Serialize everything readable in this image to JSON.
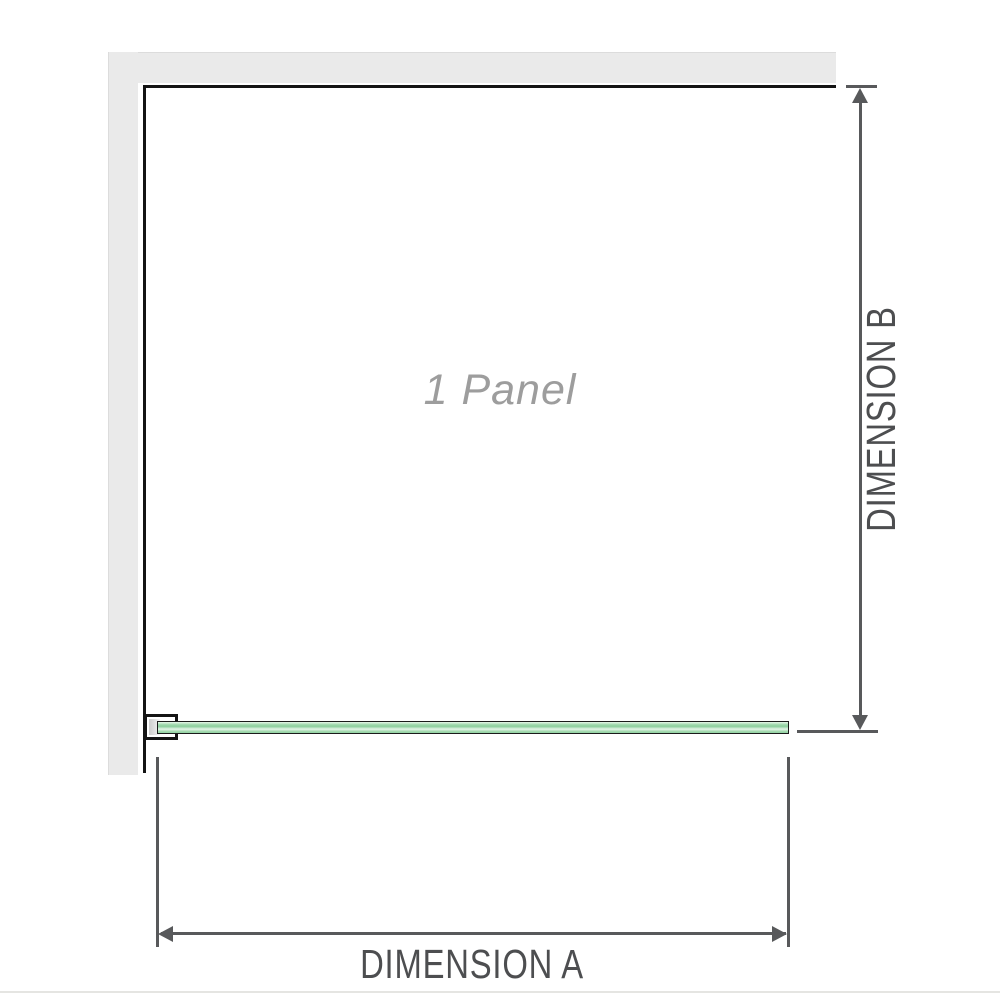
{
  "diagram": {
    "panel_label": "1 Panel",
    "dimension_a_label": "DIMENSION A",
    "dimension_b_label": "DIMENSION B"
  },
  "colors": {
    "wall": "#eaeaea",
    "wall_outer": "#dcdcdc",
    "wall_edge": "#141414",
    "glass_border": "#1b1b1b",
    "glass_green": "#8fd0a0",
    "glass_green_light": "#e3f4e7",
    "dimension": "#58595b",
    "panel_text": "#9d9d9d",
    "label_text": "#4d4e50",
    "baseline": "#e5e5e2"
  }
}
